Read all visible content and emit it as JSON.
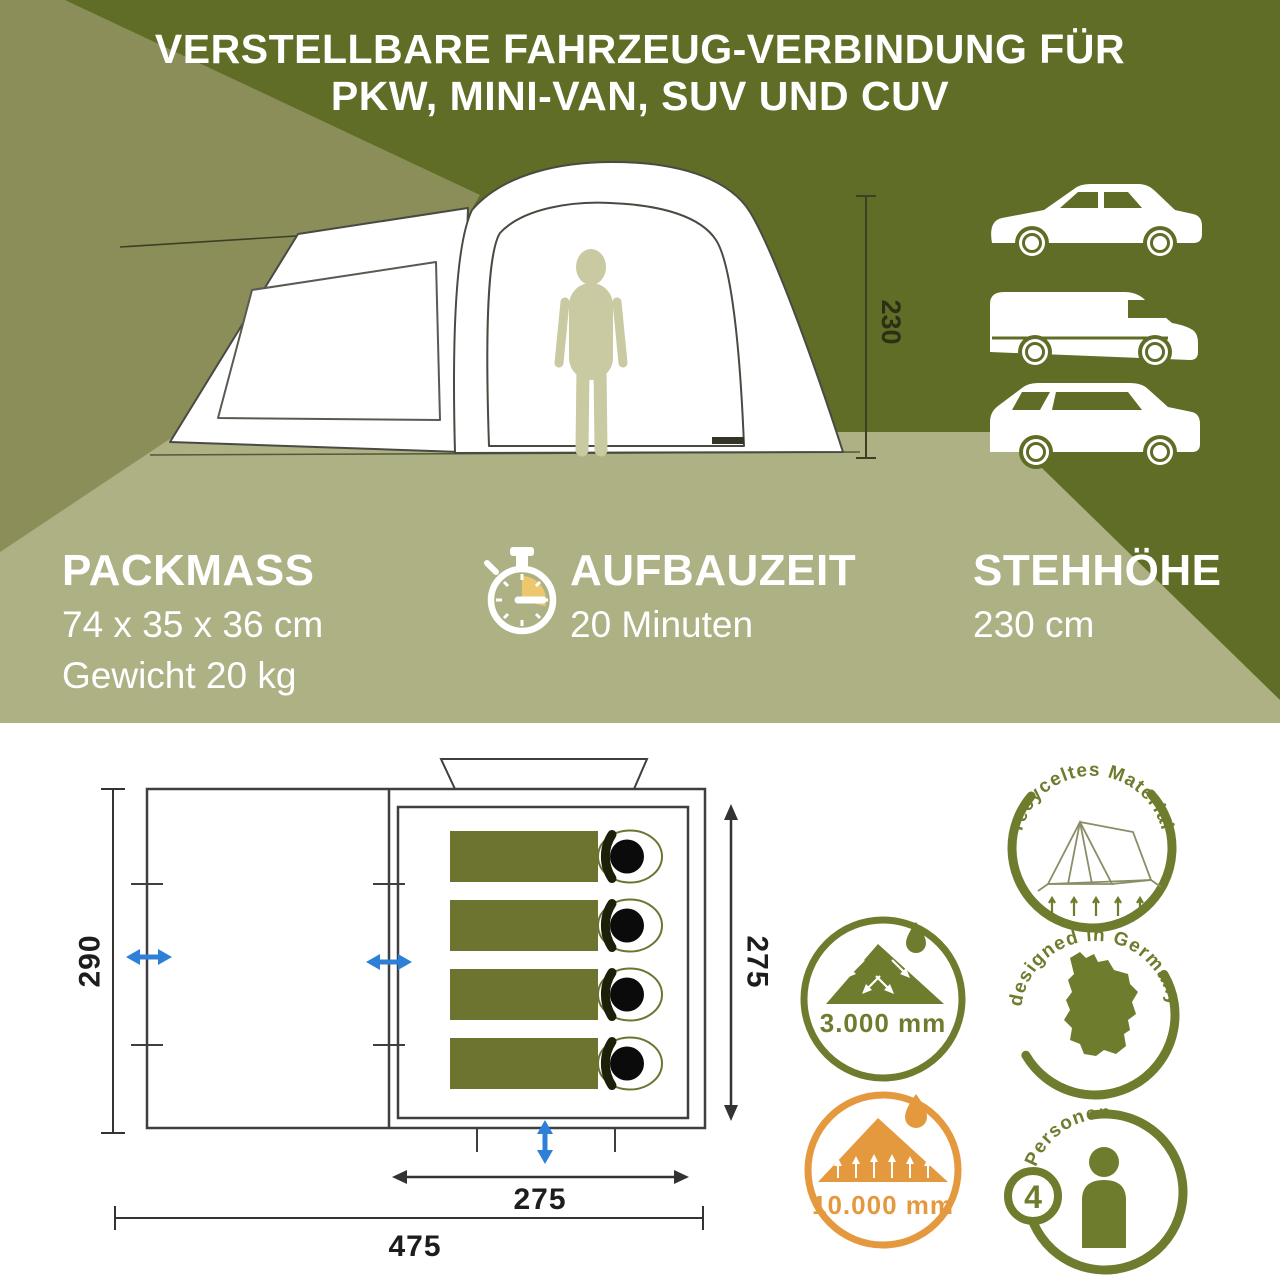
{
  "title": {
    "line1": "VERSTELLBARE FAHRZEUG-VERBINDUNG FÜR",
    "line2": "PKW, MINI-VAN, SUV UND CUV"
  },
  "hero": {
    "height_dim": "230",
    "vehicle_icons": [
      "car-icon",
      "van-icon",
      "suv-icon"
    ]
  },
  "specs": {
    "packmass": {
      "heading": "PACKMASS",
      "line1": "74 x 35 x 36 cm",
      "line2": "Gewicht 20 kg"
    },
    "aufbauzeit": {
      "heading": "AUFBAUZEIT",
      "line1": "20 Minuten",
      "icon": "stopwatch-icon"
    },
    "stehhoehe": {
      "heading": "STEHHÖHE",
      "line1": "230 cm"
    }
  },
  "floor_plan": {
    "dim_left": "290",
    "dim_cabin_height": "275",
    "dim_cabin_width": "275",
    "dim_total_width": "475",
    "sleeping_bag_count": 4
  },
  "badges": {
    "recycled_label": "recyceltes Material",
    "rain_value": "3.000 mm",
    "designed_label": "designed in Germany",
    "floor_value": "10.000 mm",
    "persons_label": "Personen",
    "persons_count": "4"
  },
  "colors": {
    "dark_olive": "#5f6d26",
    "mid_olive": "#8b8e58",
    "sage": "#adb184",
    "badge_green": "#6e7c2e",
    "badge_orange": "#e5993f",
    "arrow_blue": "#2e7fd8",
    "accent_yellow": "#ecc76d"
  }
}
